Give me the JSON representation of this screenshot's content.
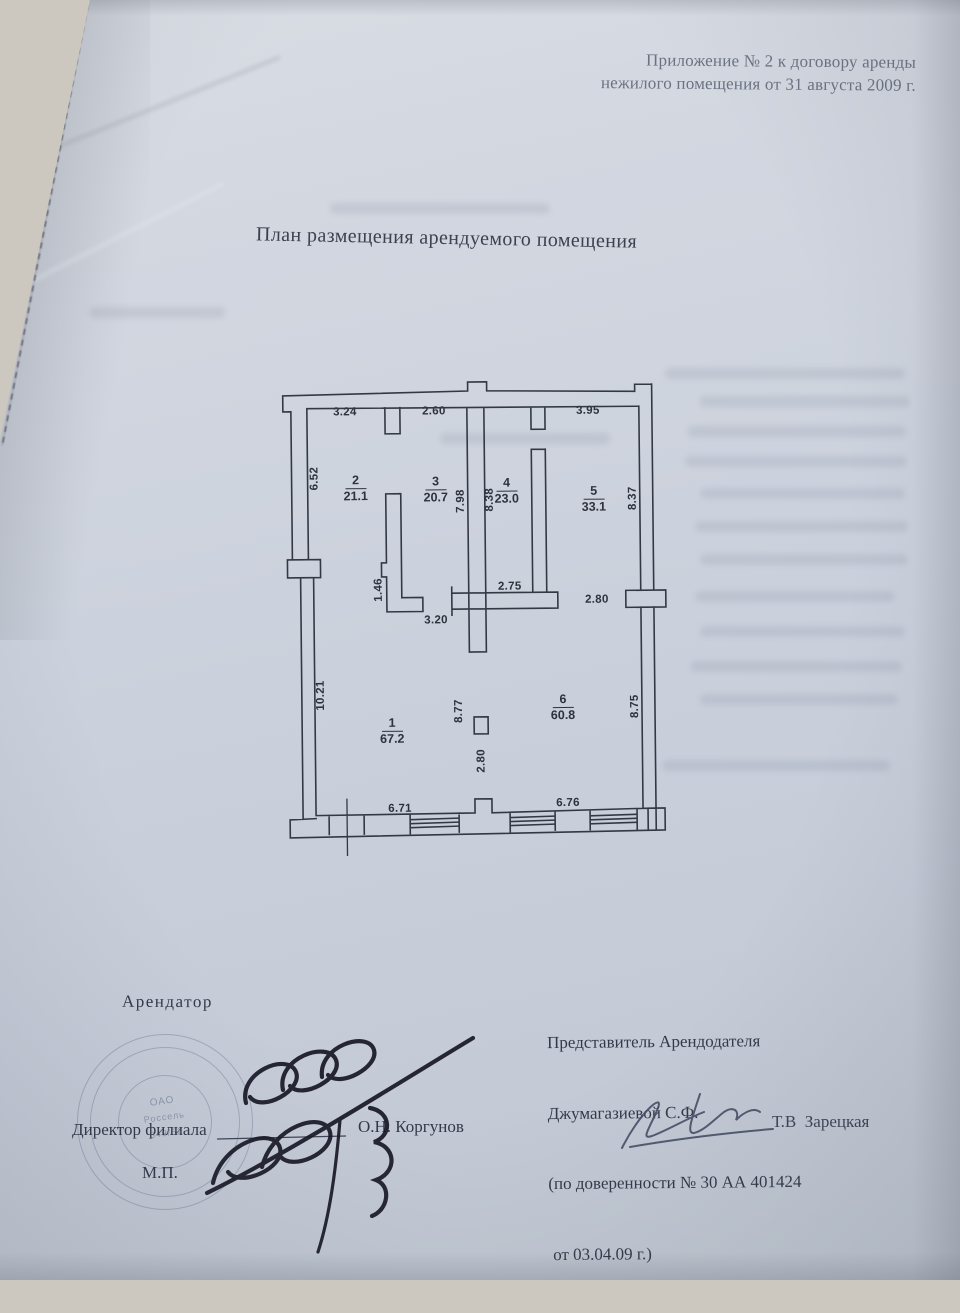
{
  "document": {
    "header": {
      "line1": "Приложение № 2 к договору аренды",
      "line2": "нежилого помещения от 31 августа 2009 г."
    },
    "title": "План размещения арендуемого помещения"
  },
  "plan": {
    "rooms": [
      {
        "num": "1",
        "area": "67.2"
      },
      {
        "num": "2",
        "area": "21.1"
      },
      {
        "num": "3",
        "area": "20.7"
      },
      {
        "num": "4",
        "area": "23.0"
      },
      {
        "num": "5",
        "area": "33.1"
      },
      {
        "num": "6",
        "area": "60.8"
      }
    ],
    "dims_horizontal": [
      "3.24",
      "2.60",
      "3.95",
      "2.75",
      "2.80",
      "3.20",
      "6.71",
      "6.76"
    ],
    "dims_vertical": [
      "6.52",
      "7.98",
      "8.38",
      "8.37",
      "1.46",
      "10.21",
      "8.77",
      "2.80",
      "8.75"
    ]
  },
  "signing": {
    "tenant": {
      "role": "Арендатор",
      "position": "Директор филиала",
      "name": "О.Н. Коргунов",
      "seal_mark": "М.П.",
      "stamp": {
        "line1": "ОАО",
        "line2": "Россель",
        "line3": "349/52"
      }
    },
    "landlord": {
      "line1": "Представитель Арендодателя",
      "line2": "Джумагазиевой С.Ф.",
      "line3": "(по доверенности № 30 АА 401424",
      "line4": " от 03.04.09 г.)",
      "name": "Т.В  Зарецкая"
    }
  }
}
